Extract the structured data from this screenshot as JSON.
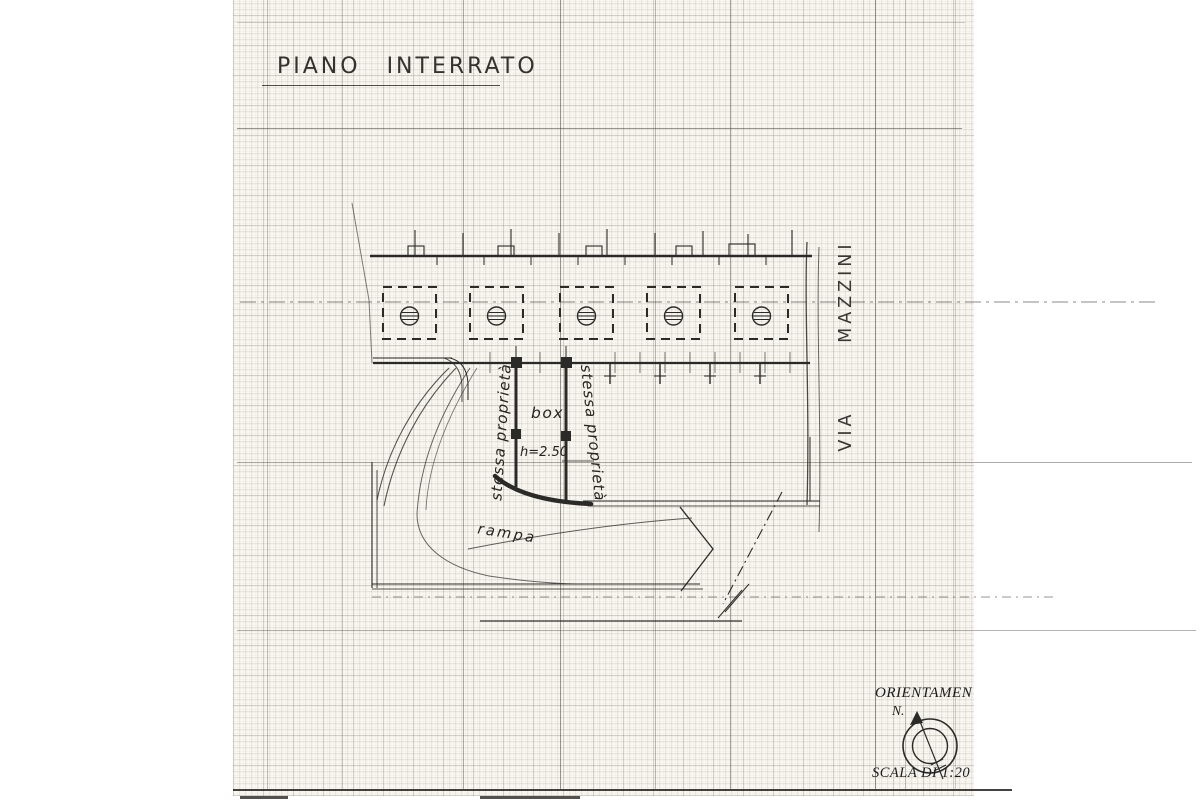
{
  "title": {
    "text": "PIANO INTERRATO"
  },
  "street": {
    "name": "VIA MAZZINI"
  },
  "annotations": {
    "property_left": "stessa proprietà",
    "property_right": "stessa proprietà",
    "box": "box",
    "box_height": "h=2.50",
    "ramp": "rampa"
  },
  "legend": {
    "orientation_title": "ORIENTAMEN",
    "north_label": "N.",
    "scale_label": "SCALA DI 1:20"
  },
  "plan": {
    "pillars": 5
  },
  "colors": {
    "paper": "#faf8f2",
    "ink": "#2a2a28",
    "grid_light": "#dedbd0",
    "page_margin": "#ffffff"
  }
}
